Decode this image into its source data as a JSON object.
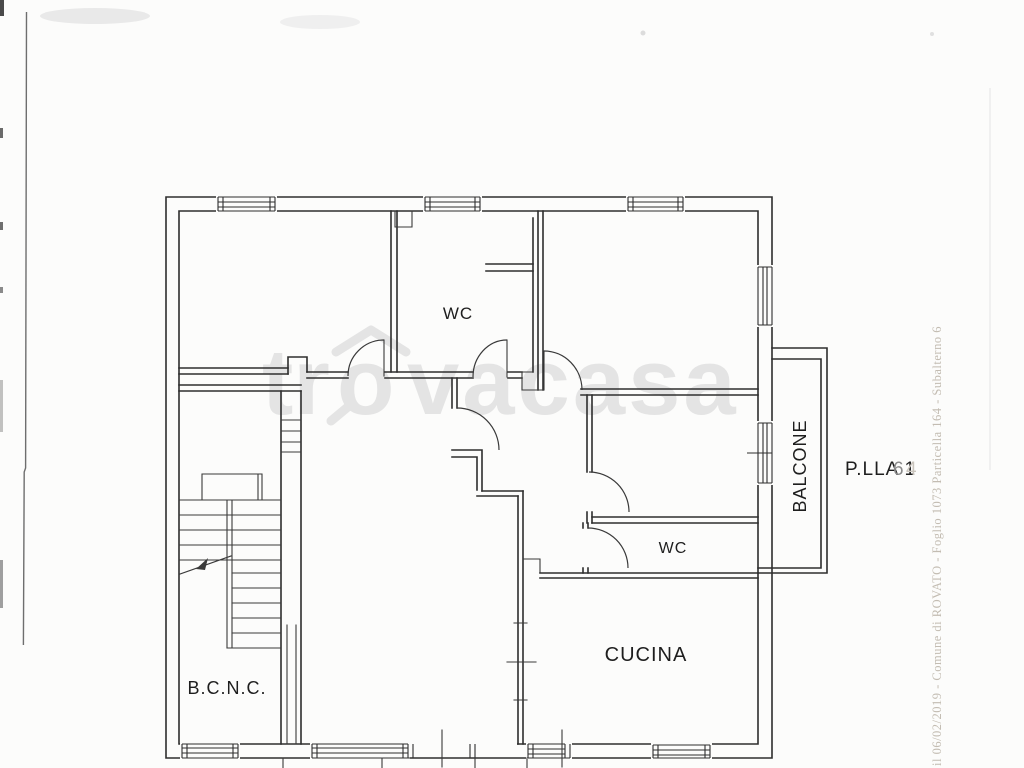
{
  "page": {
    "background": "#fcfcfb",
    "kind": "scanned floor plan"
  },
  "plan": {
    "labels": {
      "wc_upper": "WC",
      "wc_lower": "WC",
      "kitchen": "CUCINA",
      "common_area": "B.C.N.C.",
      "balcony": "BALCONE"
    },
    "parcel": {
      "prefix": "P.LLA 1",
      "digit_mid": "6",
      "digit_faint": "4"
    }
  },
  "watermark": {
    "full": "trovacasa",
    "part_tr": "tr",
    "part_o": "o",
    "part_rest": "vacasa"
  },
  "margin_note": {
    "text": "il 06/02/2019 - Comune di ROVATO - Foglio 1073 Particella 164 - Subalterno 6"
  },
  "colors": {
    "ink": "#2e2e2e",
    "label": "#1e1e1e",
    "watermark": "#e4e4e4",
    "margin_note": "#b5ada0",
    "parcel_mid": "#8a8a8a",
    "parcel_faint": "#c9c4bc",
    "artifact": "#555555"
  }
}
